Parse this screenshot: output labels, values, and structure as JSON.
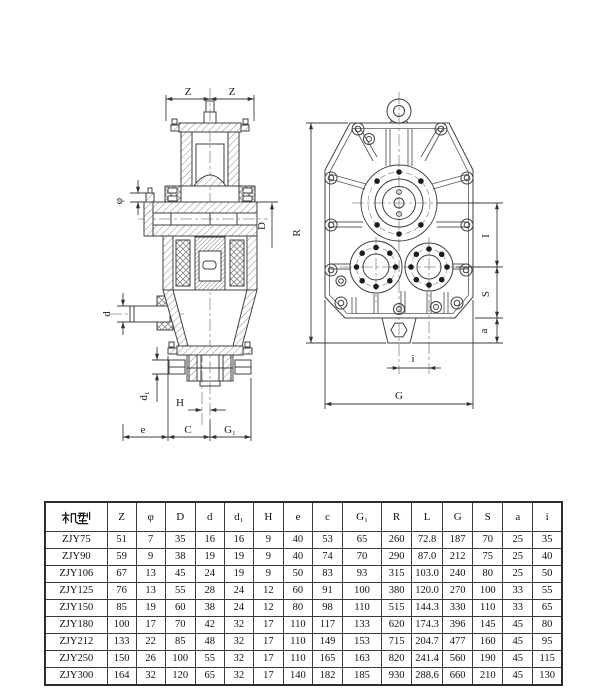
{
  "page": {
    "background": "#ffffff",
    "line_color": "#3f3f3f",
    "text_color": "#1b1b1b"
  },
  "drawing": {
    "left_view": {
      "description": "sectional side view of gear reducer",
      "labels": {
        "z_left": "Z",
        "z_right": "Z",
        "phi": "φ",
        "D": "D",
        "d": "d",
        "d1": "d₁",
        "H": "H",
        "e": "e",
        "C": "C",
        "G1": "G₁"
      }
    },
    "right_view": {
      "description": "front view of gear reducer housing",
      "labels": {
        "R": "R",
        "I": "I",
        "S": "S",
        "a": "a",
        "i": "i",
        "G": "G"
      }
    }
  },
  "table": {
    "model_header": "机型",
    "headers": [
      "机型",
      "Z",
      "φ",
      "D",
      "d",
      "d₁",
      "H",
      "e",
      "c",
      "G₁",
      "R",
      "L",
      "G",
      "S",
      "a",
      "i"
    ],
    "rows": [
      [
        "ZJY75",
        "51",
        "7",
        "35",
        "16",
        "16",
        "9",
        "40",
        "53",
        "65",
        "260",
        "72.8",
        "187",
        "70",
        "25",
        "35"
      ],
      [
        "ZJY90",
        "59",
        "9",
        "38",
        "19",
        "19",
        "9",
        "40",
        "74",
        "70",
        "290",
        "87.0",
        "212",
        "75",
        "25",
        "40"
      ],
      [
        "ZJY106",
        "67",
        "13",
        "45",
        "24",
        "19",
        "9",
        "50",
        "83",
        "93",
        "315",
        "103.0",
        "240",
        "80",
        "25",
        "50"
      ],
      [
        "ZJY125",
        "76",
        "13",
        "55",
        "28",
        "24",
        "12",
        "60",
        "91",
        "100",
        "380",
        "120.0",
        "270",
        "100",
        "33",
        "55"
      ],
      [
        "ZJY150",
        "85",
        "19",
        "60",
        "38",
        "24",
        "12",
        "80",
        "98",
        "110",
        "515",
        "144.3",
        "330",
        "110",
        "33",
        "65"
      ],
      [
        "ZJY180",
        "100",
        "17",
        "70",
        "42",
        "32",
        "17",
        "110",
        "117",
        "133",
        "620",
        "174.3",
        "396",
        "145",
        "45",
        "80"
      ],
      [
        "ZJY212",
        "133",
        "22",
        "85",
        "48",
        "32",
        "17",
        "110",
        "149",
        "153",
        "715",
        "204.7",
        "477",
        "160",
        "45",
        "95"
      ],
      [
        "ZJY250",
        "150",
        "26",
        "100",
        "55",
        "32",
        "17",
        "110",
        "165",
        "163",
        "820",
        "241.4",
        "560",
        "190",
        "45",
        "115"
      ],
      [
        "ZJY300",
        "164",
        "32",
        "120",
        "65",
        "32",
        "17",
        "140",
        "182",
        "185",
        "930",
        "288.6",
        "660",
        "210",
        "45",
        "130"
      ]
    ]
  }
}
